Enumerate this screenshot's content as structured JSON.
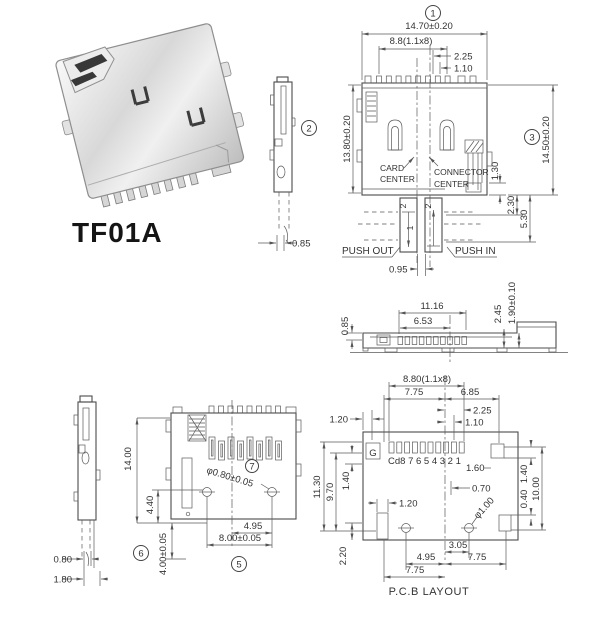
{
  "drawing": {
    "model": "TF01A",
    "callouts": {
      "c1": "1",
      "c2": "2",
      "c3": "3",
      "c5": "5",
      "c6": "6",
      "c7": "7"
    },
    "front_view": {
      "dim_width": "14.70±0.20",
      "dim_pins": "8.8(1.1x8)",
      "dim_2_25": "2.25",
      "dim_1_10": "1.10",
      "dim_h_left": "13.80±0.20",
      "dim_h_right": "14.50±0.20",
      "label_card_1": "CARD",
      "label_card_2": "CENTER",
      "label_conn_1": "CONNECTOR",
      "label_conn_2": "CENTER",
      "dim_1_30": "1.30",
      "dim_2_30": "2.30",
      "dim_5_30": "5.30",
      "label_push_out": "PUSH OUT",
      "label_push_in": "PUSH IN",
      "dim_0_95": "0.95",
      "mark_left": "2",
      "mark_right": "2",
      "mark_inner": "1"
    },
    "side_view": {
      "dim_0_85": "0.85"
    },
    "rear_view": {
      "dim_11_16": "11.16",
      "dim_6_53": "6.53",
      "dim_0_85": "0.85",
      "dim_2_45": "2.45",
      "dim_1_90": "1.90±0.10"
    },
    "bottom_side_view": {
      "dim_0_80": "0.80",
      "dim_1_80": "1.80"
    },
    "top_view": {
      "dim_14_00": "14.00",
      "dim_4_40": "4.40",
      "dim_4_00": "4.00±0.05",
      "dim_hole": "φ0.80±0.05",
      "dim_4_95": "4.95",
      "dim_8_00": "8.00±0.05"
    },
    "pcb_layout": {
      "title": "P.C.B LAYOUT",
      "dim_8_80": "8.80(1.1x8)",
      "dim_7_75_top": "7.75",
      "dim_6_85": "6.85",
      "dim_2_25": "2.25",
      "dim_1_10": "1.10",
      "dim_1_20_top": "1.20",
      "pad_g": "G",
      "pad_numbers": "Cd8 7 6 5 4 3 2 1",
      "dim_1_60": "1.60",
      "dim_0_70": "0.70",
      "dim_11_30": "11.30",
      "dim_9_70": "9.70",
      "dim_1_40_left": "1.40",
      "dim_1_20_mid": "1.20",
      "dim_2_20": "2.20",
      "dim_hole": "φ1.00",
      "dim_1_40_right": "1.40",
      "dim_10_00": "10.00",
      "dim_0_40": "0.40",
      "dim_3_05": "3.05",
      "dim_4_95": "4.95",
      "dim_7_75_right": "7.75",
      "dim_7_75_bottom": "7.75"
    }
  }
}
